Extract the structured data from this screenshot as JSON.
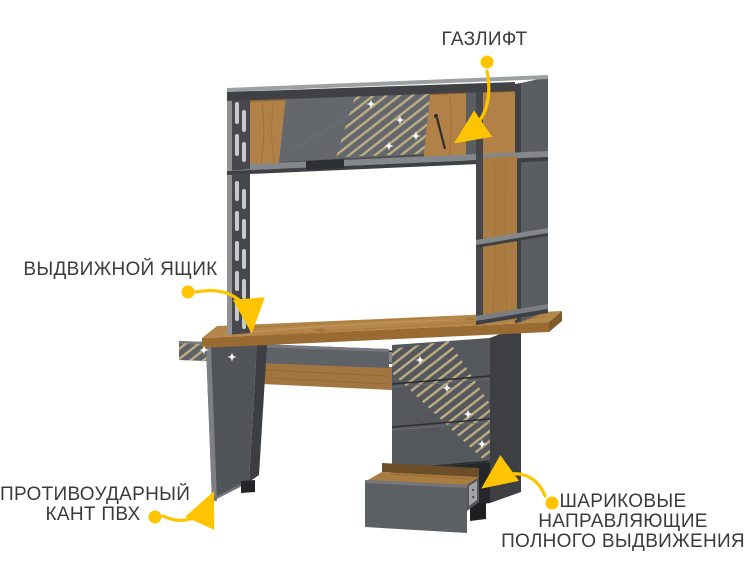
{
  "annotations": {
    "gas_lift": {
      "label": "ГАЗЛИФТ"
    },
    "drawer": {
      "label": "ВЫДВИЖНОЙ ЯЩИК"
    },
    "pvc_edge": {
      "line1": "ПРОТИВОУДАРНЫЙ",
      "line2": "КАНТ ПВХ"
    },
    "ball_slides": {
      "line1": "ШАРИКОВЫЕ",
      "line2": "НАПРАВЛЯЮЩИЕ",
      "line3": "ПОЛНОГО ВЫДВИЖЕНИЯ"
    }
  },
  "colors": {
    "accent_yellow": "#ffc400",
    "label_text": "#3b3b3b",
    "wood_top": "#b4864a",
    "wood_dark": "#996b33",
    "gray_front": "#54575c",
    "gray_dark": "#3d3f42",
    "stripe_gold": "#c8b584",
    "background": "#ffffff"
  }
}
